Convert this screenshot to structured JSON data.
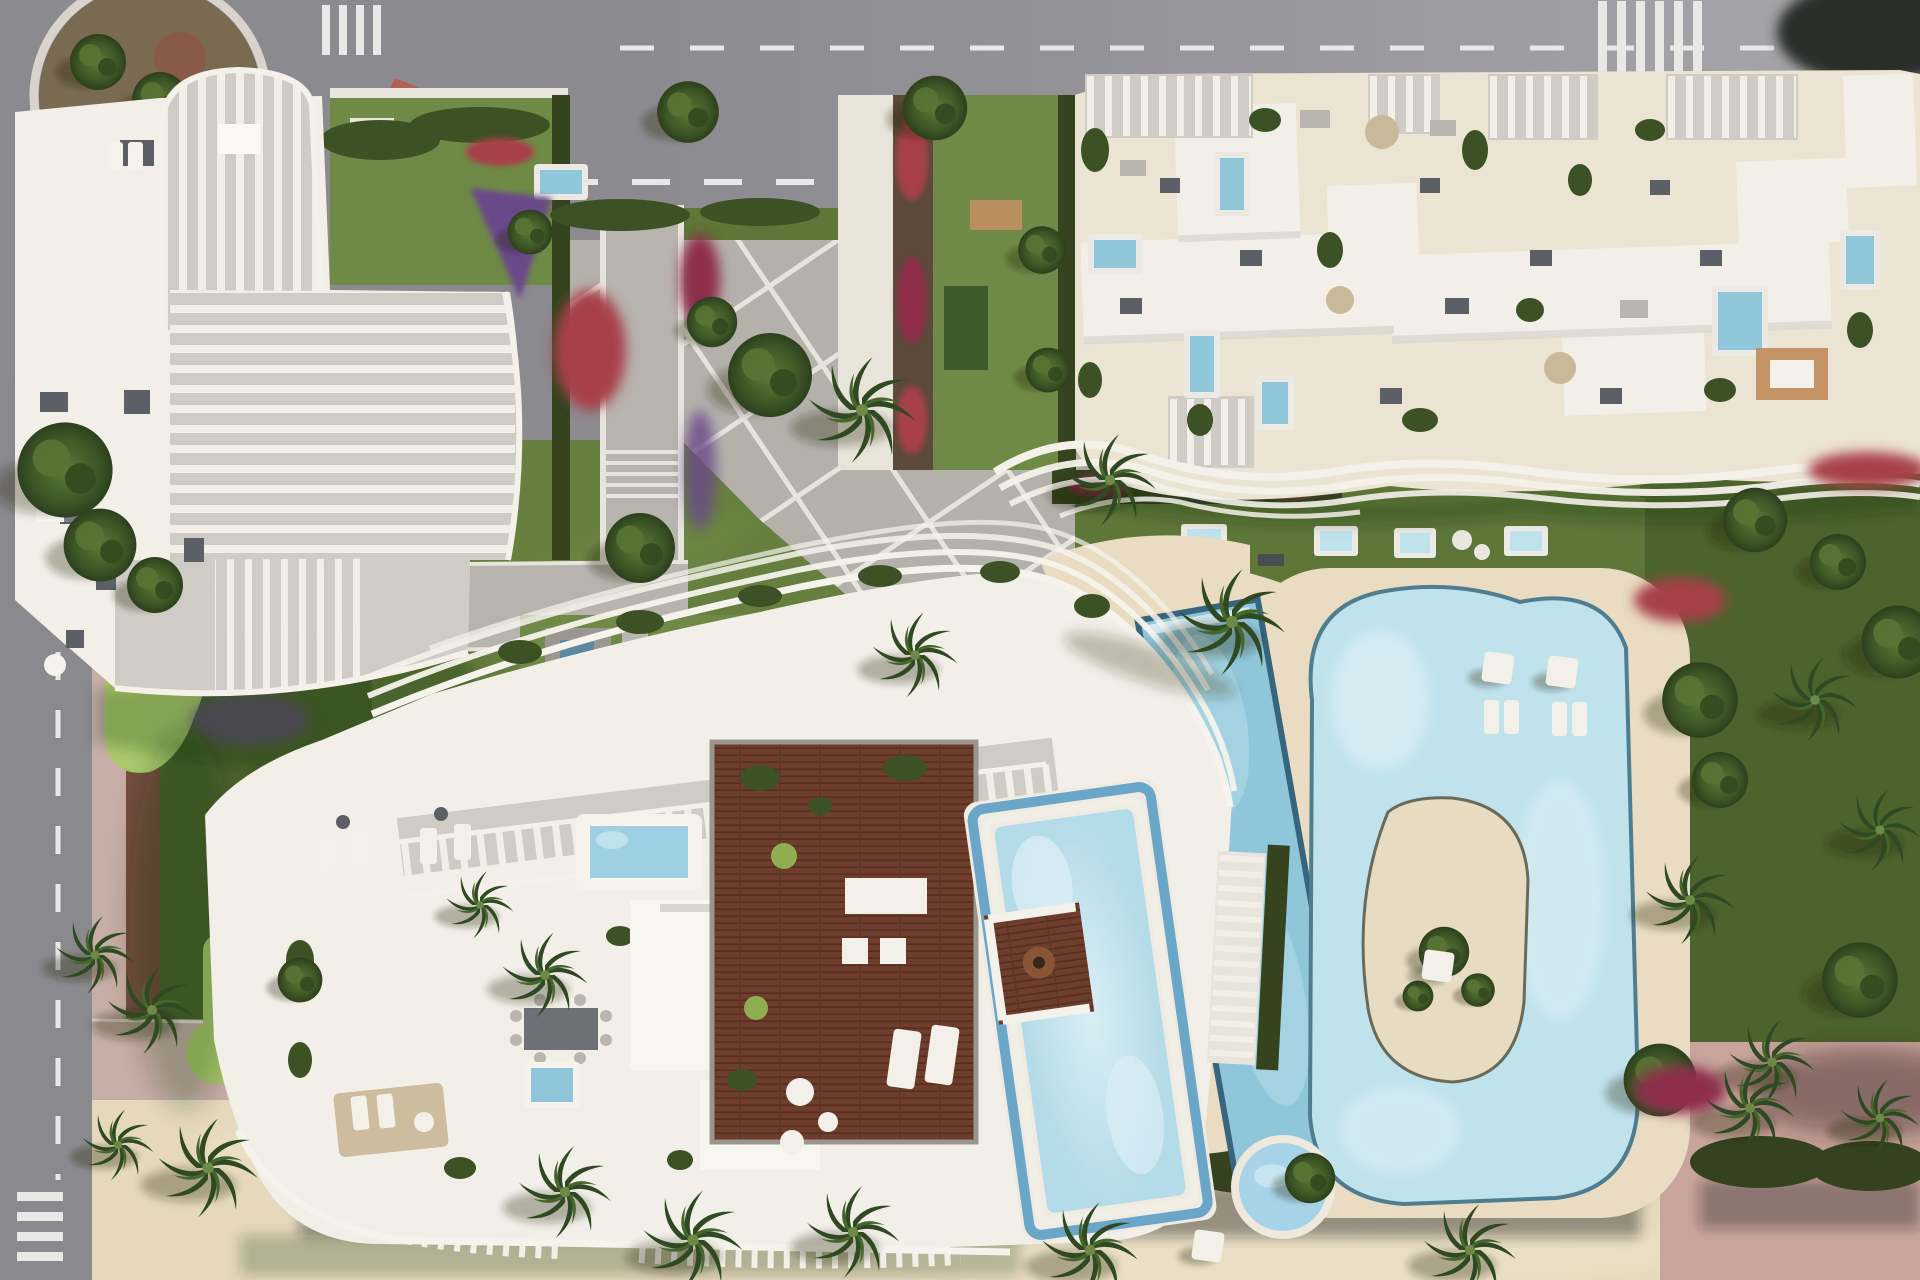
{
  "scene": {
    "kind": "aerial-architectural-render",
    "description-of-pixels": "top-down 3D rendering of a residential complex: three white apartment buildings with sculpted rooftop pergolas, central paved plaza, landscaped gardens, large free-form swimming pools with island, lap pool, jacuzzi, mini-golf lawn, roundabout and asphalt roads at top and left, sandy promenade with hedge row at bottom",
    "elements": [
      "top-road",
      "left-road",
      "roundabout",
      "zebra-crosswalks",
      "road-arrow",
      "white-van",
      "red-paved-corner",
      "building-top-left",
      "building-top-right",
      "building-bottom",
      "rooftop-terraces",
      "rooftop-plunge-pools",
      "central-plaza",
      "paved-paths",
      "stair-steps",
      "garden-lawns",
      "red-flower-beds",
      "purple-flower-beds",
      "pool-deck",
      "free-form-pool",
      "pool-island",
      "lap-pool",
      "beach-crescent",
      "jacuzzi",
      "pergola-arc",
      "sun-umbrellas",
      "loungers",
      "mini-golf-greens",
      "planter-ring",
      "wooden-roof-deck",
      "roof-pool-with-island",
      "hedge-band",
      "palm-trees",
      "round-trees",
      "sand-promenade",
      "pink-paths"
    ]
  },
  "palette": {
    "asphalt": "#8d8c90",
    "asphaltLight": "#a5a4a8",
    "roadMark": "#e9e8e6",
    "sidewalkPink": "#c6ada5",
    "sandPath": "#cfb6ab",
    "sandDeck": "#e9dcc2",
    "sandGround": "#e5d8bc",
    "lawn": "#5e7638",
    "lawnBright": "#6f8a46",
    "lawnDark": "#4c632d",
    "golfGreen": "#a9c86b",
    "hedge": "#35431f",
    "treeDark": "#2f4a22",
    "treeMid": "#4e6a2e",
    "flowersRed": "#a83f48",
    "flowersMagenta": "#8e2f4c",
    "flowersPurple": "#6a4a8a",
    "buildingWhite": "#f2efe8",
    "buildingCream": "#ece4d2",
    "slatGray": "#cfccc5",
    "roofBox": "#5c5f66",
    "woodDeck": "#6e3d2c",
    "woodTable": "#b98d5e",
    "poolWater": "#bfe2ec",
    "poolWaterLight": "#dcEFf4",
    "poolRim": "#4f7d90",
    "lapPool": "#8fc6da",
    "lapRim": "#38657e",
    "jacuzzi": "#a6d3e8",
    "shadow": "rgba(25,28,18,0.22)"
  }
}
